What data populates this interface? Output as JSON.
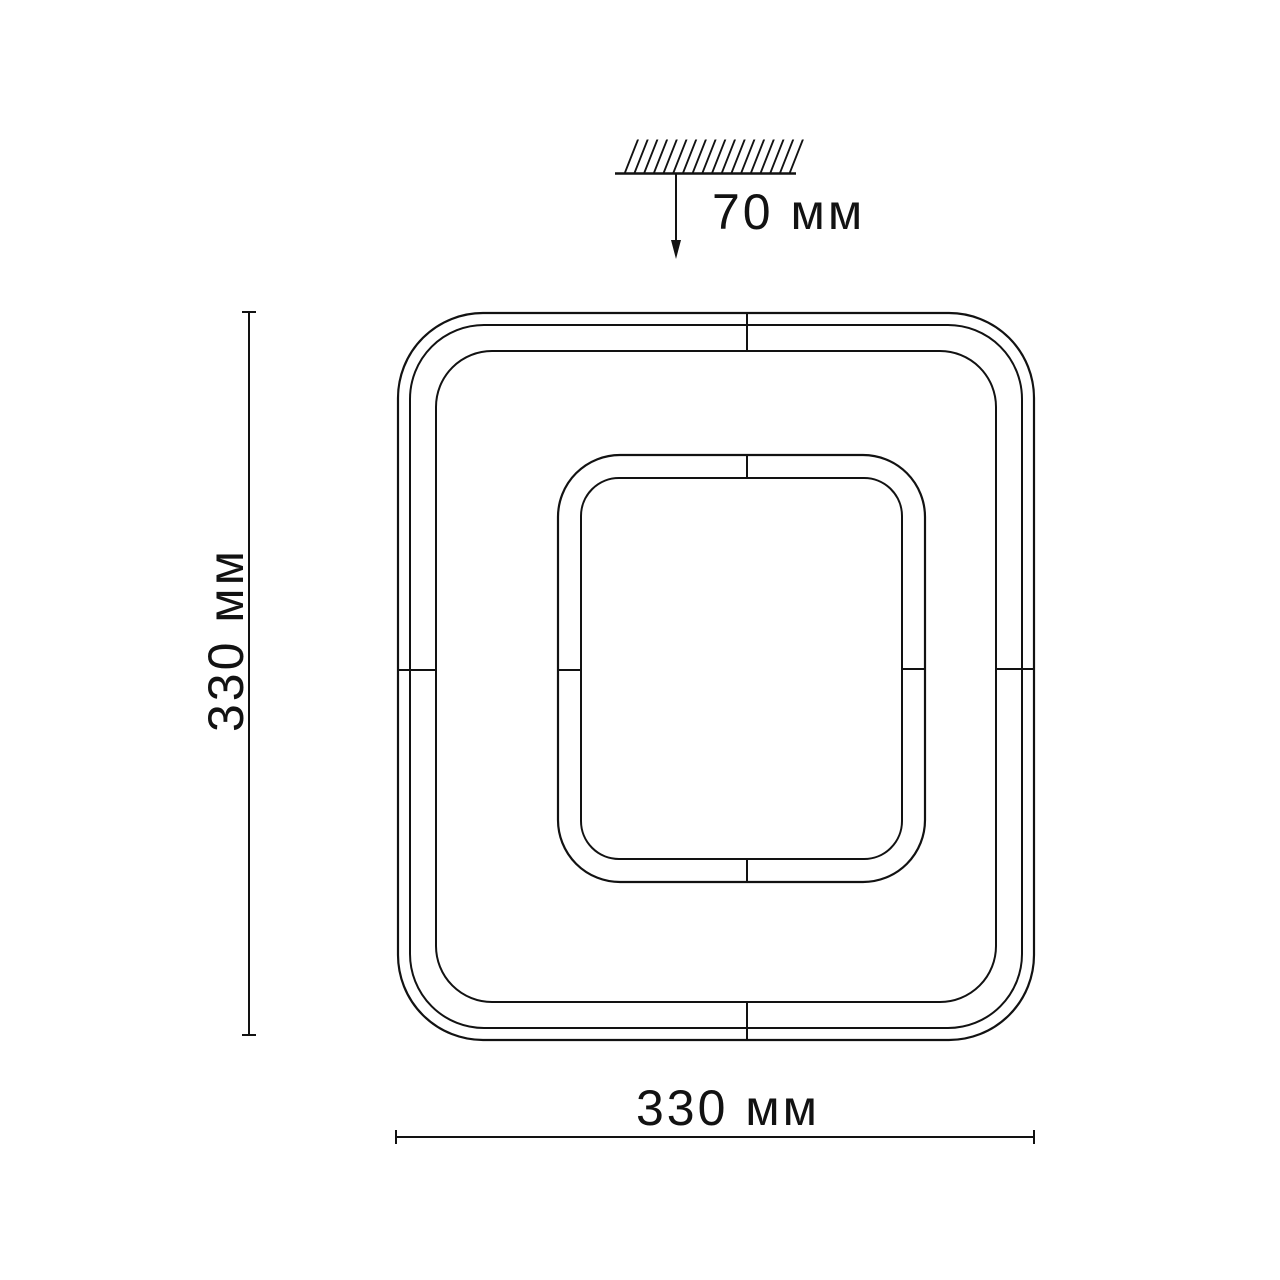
{
  "diagram": {
    "kind": "ceiling-light-dimension-drawing",
    "labels": {
      "mount_height": "70 мм",
      "height": "330 мм",
      "width": "330 мм"
    }
  },
  "icons": {
    "ceiling_hatch": "diagonal-hatch-strokes",
    "down_arrow": "filled-triangle-down"
  },
  "colors": {
    "line": "#121212",
    "text": "#121212",
    "background": "#ffffff"
  }
}
